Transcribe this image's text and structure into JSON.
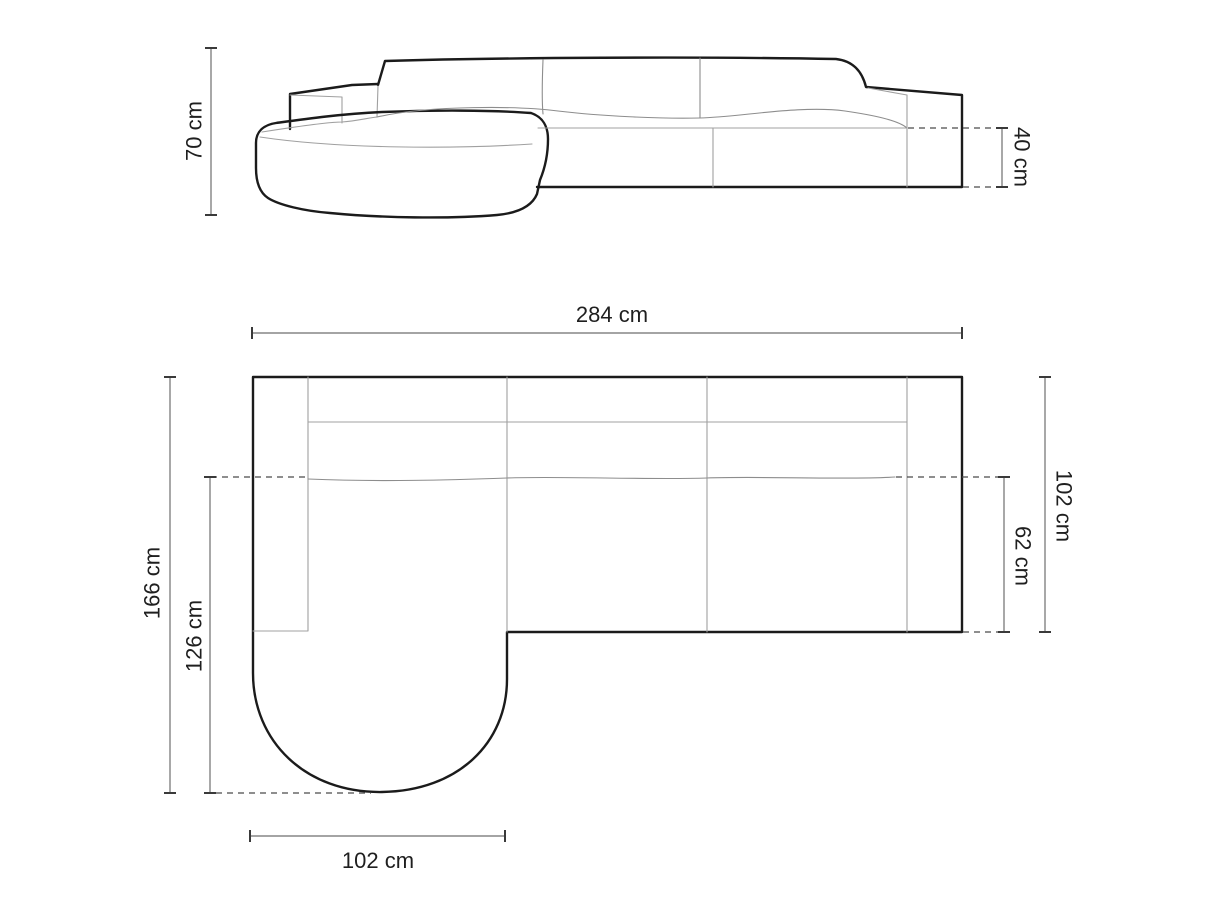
{
  "front_elevation": {
    "overall_height": "70 cm",
    "seat_height": "40 cm"
  },
  "top_plan": {
    "overall_width": "284 cm",
    "overall_depth": "166 cm",
    "chaise_depth": "126 cm",
    "sofa_depth": "102 cm",
    "seat_depth": "62 cm",
    "chaise_width": "102 cm"
  },
  "colors": {
    "background": "#ffffff",
    "outline": "#1b1b1b",
    "interior_line": "#a0a0a0",
    "dimension_line": "#6e6e6e",
    "dashed_line": "#4a4a4a",
    "label_text": "#1f1f1f"
  }
}
